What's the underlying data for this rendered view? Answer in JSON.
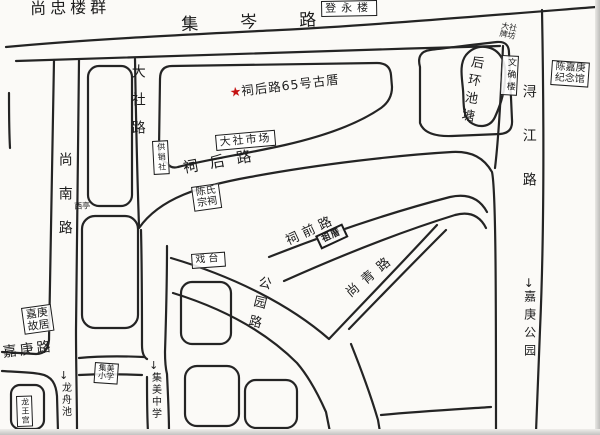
{
  "title": "hand-drawn neighborhood map of Jimei Dashe",
  "colors": {
    "ink": "#1c1c1c",
    "star_red": "#c41111",
    "paper": "#fbfaf7"
  },
  "marker": {
    "star": "★",
    "text": "祠后路65号古厝"
  },
  "roads": {
    "jicen": "集岑路",
    "dashe": "大社路",
    "shangnan": "尚南路",
    "xunjiang": "浔江路",
    "cihou": "祠后路",
    "ciqian": "祠前路",
    "gongyuan": "公园路",
    "shangqing": "尚青路",
    "jiageng": "嘉庚路"
  },
  "places": {
    "shangzhong": "尚忠楼群",
    "dengyong": "登永楼",
    "paifang_l1": "大社",
    "paifang_l2": "牌坊",
    "memorial_l1": "陈嘉庚",
    "memorial_l2": "纪念馆",
    "pond": "后环池塘",
    "wenque": "文确楼",
    "market": "大社市场",
    "coop": "供销社",
    "xiting": "西亭",
    "zongci_l1": "陈氏",
    "zongci_l2": "宗祠",
    "stage": "戏台",
    "zucuo": "祖厝",
    "guju_l1": "嘉庚",
    "guju_l2": "故居",
    "primary_l1": "集美",
    "primary_l2": "小学",
    "longwang": "龙王宫"
  },
  "directions": {
    "arrow": "↓",
    "longzhouchi": "龙舟池",
    "jimei_middle": "集美中学",
    "jiageng_park": "嘉庚公园"
  }
}
